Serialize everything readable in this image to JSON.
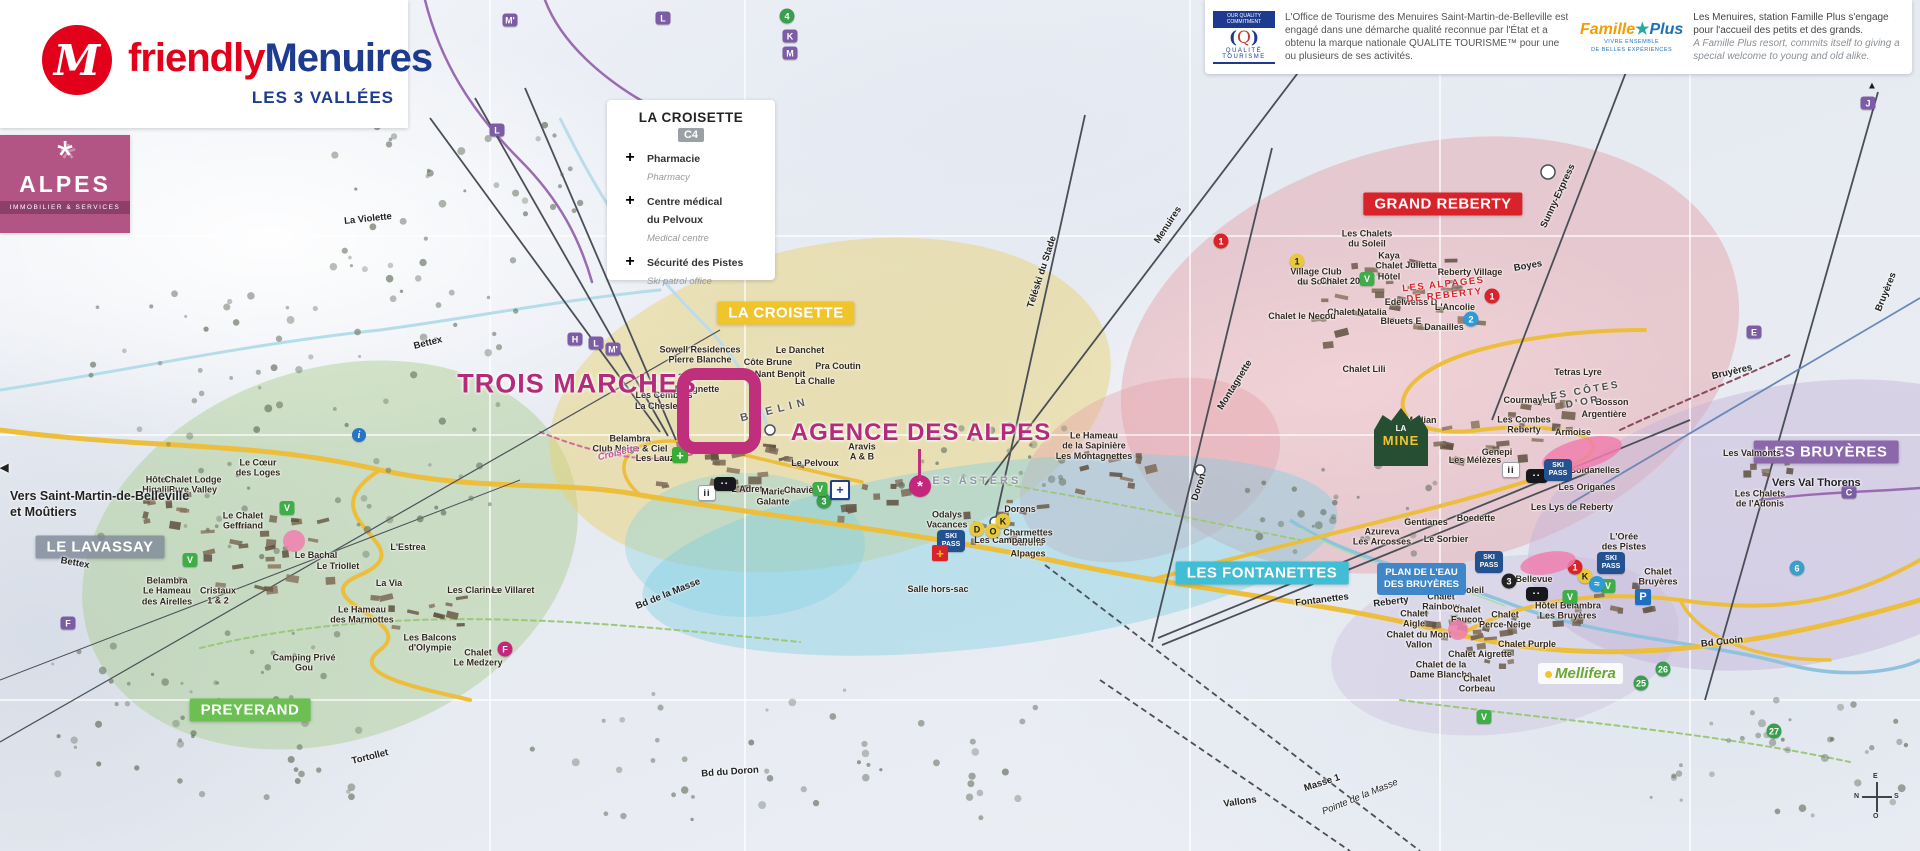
{
  "branding": {
    "logo_icon": "M",
    "logo_friendly": "friendly",
    "logo_menuires": "Menuires",
    "logo_sub": "LES 3 VALLÉES",
    "alpes_icon": "*",
    "alpes_title": "ALPES",
    "alpes_sub": "IMMOBILIER & SERVICES"
  },
  "legend": {
    "title": "LA CROISETTE",
    "grid_ref": "C4",
    "items": [
      {
        "icon": "pharmacy-cross",
        "glyph": "+",
        "fr": "Pharmacie",
        "en": "Pharmacy",
        "cls": "ph"
      },
      {
        "icon": "medical-cross",
        "glyph": "+",
        "fr": "Centre médical\ndu Pelvoux",
        "en": "Medical centre",
        "cls": "med"
      },
      {
        "icon": "ski-patrol-cross",
        "glyph": "+",
        "fr": "Sécurité des Pistes",
        "en": "Ski patrol office",
        "cls": "pat"
      }
    ]
  },
  "quality": {
    "commit": "OUR QUALITY\nCOMMITMENT",
    "art": "Q",
    "name": "QUALITÉ\nTOURISME",
    "text": "L'Office de Tourisme des Menuires Saint-Martin-de-Belleville est engagé dans une démarche qualité reconnue par l'État et a obtenu la marque nationale QUALITE TOURISME™ pour une ou plusieurs de ses activités."
  },
  "famille": {
    "fam": "Famille",
    "star": "★",
    "plus": "Plus",
    "sub": "VIVRE ENSEMBLE\nDE BELLES EXPÉRIENCES",
    "text_fr": "Les Menuires, station Famille Plus s'engage pour l'accueil des petits et des grands.",
    "text_en": "A Famille Plus resort, commits itself to giving a special welcome to young and old alike."
  },
  "highlights": {
    "trois_marches": "TROIS MARCHES",
    "agence": "AGENCE DES ALPES"
  },
  "edges": {
    "vers_left": "Vers Saint-Martin-de-Belleville\net Moûtiers",
    "vers_left_arrow": "◀",
    "vers_right": "Vers Val Thorens",
    "la_mine_top": "LA",
    "la_mine_main": "MINE",
    "plan_eau": "PLAN DE L'EAU\nDES BRUYÈRES",
    "mellifera": "Mellifera",
    "compass": {
      "top": "E",
      "bottom": "O",
      "left": "N",
      "right": "S"
    }
  },
  "districts": [
    {
      "n": "district-la-croisette",
      "t": "LA CROISETTE",
      "x": 786,
      "y": 313,
      "bg": "#f0c52c"
    },
    {
      "n": "district-grand-reberty",
      "t": "GRAND REBERTY",
      "x": 1443,
      "y": 204,
      "bg": "#d8232a"
    },
    {
      "n": "district-les-fontanettes",
      "t": "LES FONTANETTES",
      "x": 1262,
      "y": 573,
      "bg": "#41bdd6"
    },
    {
      "n": "district-les-bruyeres",
      "t": "LES BRUYÈRES",
      "x": 1826,
      "y": 452,
      "bg": "#8a68aa"
    },
    {
      "n": "district-preyerand",
      "t": "PREYERAND",
      "x": 250,
      "y": 710,
      "bg": "#6cbf53"
    },
    {
      "n": "district-le-lavassay",
      "t": "LE LAVASSAY",
      "x": 100,
      "y": 547,
      "bg": "rgba(125,135,150,0.8)"
    }
  ],
  "places": [
    {
      "n": "label-sowell",
      "t": "Sowell Residences\nPierre Blanche",
      "x": 700,
      "y": 355
    },
    {
      "t": "Le Danchet",
      "x": 800,
      "y": 350
    },
    {
      "t": "Côte Brune",
      "x": 768,
      "y": 362
    },
    {
      "t": "Pra Coutin",
      "x": 838,
      "y": 366
    },
    {
      "t": "Nant Benoit",
      "x": 780,
      "y": 374
    },
    {
      "t": "La Challe",
      "x": 815,
      "y": 381
    },
    {
      "t": "3 Marches",
      "x": 700,
      "y": 377
    },
    {
      "t": "Dougnette",
      "x": 697,
      "y": 389
    },
    {
      "t": "Les Cembros",
      "x": 664,
      "y": 395
    },
    {
      "t": "La Chesleia",
      "x": 660,
      "y": 406
    },
    {
      "t": "Belambra\nClub Neige & Ciel",
      "x": 630,
      "y": 444
    },
    {
      "t": "Les Lauzes",
      "x": 660,
      "y": 458
    },
    {
      "t": "Le Pelvoux",
      "x": 815,
      "y": 463
    },
    {
      "t": "Aravis\nA & B",
      "x": 862,
      "y": 452
    },
    {
      "t": "L'Adret",
      "x": 747,
      "y": 489
    },
    {
      "t": "Marie\nGalante",
      "x": 773,
      "y": 497
    },
    {
      "t": "Chavière",
      "x": 803,
      "y": 490
    },
    {
      "t": "Odalys\nVacances",
      "x": 947,
      "y": 520
    },
    {
      "t": "Dorons",
      "x": 1020,
      "y": 509
    },
    {
      "t": "Charmettes\nBurons\nAlpages",
      "x": 1028,
      "y": 543
    },
    {
      "t": "Le Hameau\nde la Sapinière",
      "x": 1094,
      "y": 441
    },
    {
      "t": "Les Montagnettes",
      "x": 1094,
      "y": 456
    },
    {
      "t": "Salle hors-sac",
      "x": 938,
      "y": 589
    },
    {
      "t": "Hôtel\nHigalik",
      "x": 157,
      "y": 485
    },
    {
      "t": "Chalet Lodge\nPure Valley",
      "x": 193,
      "y": 485
    },
    {
      "t": "Le Cœur\ndes Loges",
      "x": 258,
      "y": 468
    },
    {
      "t": "Le Chalet\nGeffriand",
      "x": 243,
      "y": 521
    },
    {
      "t": "Belambra\nLe Hameau\ndes Airelles",
      "x": 167,
      "y": 591
    },
    {
      "t": "Cristaux\n1 & 2",
      "x": 218,
      "y": 596
    },
    {
      "t": "Le Bachal",
      "x": 316,
      "y": 555
    },
    {
      "t": "Le Triollet",
      "x": 338,
      "y": 566
    },
    {
      "t": "La Via",
      "x": 389,
      "y": 583
    },
    {
      "t": "L'Estrea",
      "x": 408,
      "y": 547
    },
    {
      "t": "Les Clarines",
      "x": 474,
      "y": 590
    },
    {
      "t": "Le Villaret",
      "x": 513,
      "y": 590
    },
    {
      "t": "Le Hameau\ndes Marmottes",
      "x": 362,
      "y": 615
    },
    {
      "t": "Les Balcons\nd'Olympie",
      "x": 430,
      "y": 643
    },
    {
      "t": "Chalet\nLe Medzery",
      "x": 478,
      "y": 658
    },
    {
      "t": "Camping Privé\nGou",
      "x": 304,
      "y": 663
    },
    {
      "t": "Les Chalets\ndu Soleil",
      "x": 1367,
      "y": 239
    },
    {
      "t": "Village Club\ndu Soleil",
      "x": 1316,
      "y": 277
    },
    {
      "t": "Kaya\nChalet\nHôtel",
      "x": 1389,
      "y": 266
    },
    {
      "t": "Julietta",
      "x": 1421,
      "y": 265
    },
    {
      "t": "Chalet 2000",
      "x": 1345,
      "y": 281
    },
    {
      "t": "Reberty Village",
      "x": 1470,
      "y": 272
    },
    {
      "t": "Edelweiss D",
      "x": 1411,
      "y": 302
    },
    {
      "t": "L'Ancolie",
      "x": 1455,
      "y": 307
    },
    {
      "t": "Bleuets E",
      "x": 1401,
      "y": 321
    },
    {
      "t": "Danailles",
      "x": 1444,
      "y": 327
    },
    {
      "t": "Chalet Natalia",
      "x": 1357,
      "y": 312
    },
    {
      "t": "Chalet le Necou",
      "x": 1302,
      "y": 316
    },
    {
      "t": "Chalet Lili",
      "x": 1364,
      "y": 369
    },
    {
      "t": "Tetras Lyre",
      "x": 1578,
      "y": 372
    },
    {
      "t": "Courmayeur",
      "x": 1530,
      "y": 400
    },
    {
      "t": "Bosson",
      "x": 1612,
      "y": 402
    },
    {
      "t": "Argentière",
      "x": 1604,
      "y": 414
    },
    {
      "t": "Les Combes\nReberty",
      "x": 1524,
      "y": 425
    },
    {
      "t": "Armoise",
      "x": 1573,
      "y": 432
    },
    {
      "t": "Median",
      "x": 1421,
      "y": 420
    },
    {
      "t": "Genepi",
      "x": 1497,
      "y": 452
    },
    {
      "t": "Les Mélèzes",
      "x": 1475,
      "y": 460
    },
    {
      "t": "Les Soldanelles",
      "x": 1586,
      "y": 470
    },
    {
      "t": "Les Origanes",
      "x": 1587,
      "y": 487
    },
    {
      "t": "Les Lys de Reberty",
      "x": 1572,
      "y": 507
    },
    {
      "t": "Gentianes",
      "x": 1426,
      "y": 522
    },
    {
      "t": "Azureva\nLes Arcosses",
      "x": 1382,
      "y": 537
    },
    {
      "t": "Le Sorbier",
      "x": 1446,
      "y": 539
    },
    {
      "t": "Boedette",
      "x": 1476,
      "y": 518
    },
    {
      "t": "La Biellaz",
      "x": 1411,
      "y": 575
    },
    {
      "t": "Ski Soleil",
      "x": 1464,
      "y": 590
    },
    {
      "t": "Chalet\nRainbow",
      "x": 1441,
      "y": 602
    },
    {
      "t": "Chalet\nAigle",
      "x": 1414,
      "y": 619
    },
    {
      "t": "Chalet\nFaucon",
      "x": 1467,
      "y": 615
    },
    {
      "t": "Chalet du Mont\nVallon",
      "x": 1419,
      "y": 640
    },
    {
      "t": "Chalet\nPerce-Neige",
      "x": 1505,
      "y": 620
    },
    {
      "t": "Chalet Purple",
      "x": 1527,
      "y": 644
    },
    {
      "t": "Chalet Aigrette",
      "x": 1480,
      "y": 654
    },
    {
      "t": "Chalet de la\nDame Blanche",
      "x": 1441,
      "y": 670
    },
    {
      "t": "Chalet\nCorbeau",
      "x": 1477,
      "y": 684
    },
    {
      "t": "Hôtel Belambra\nLes Bruyères",
      "x": 1568,
      "y": 611
    },
    {
      "t": "L'Orée\ndes Pistes",
      "x": 1624,
      "y": 542
    },
    {
      "t": "Bellevue",
      "x": 1534,
      "y": 579
    },
    {
      "t": "Chalet\nBruyères",
      "x": 1658,
      "y": 577
    },
    {
      "t": "Les Campanules",
      "x": 1010,
      "y": 540
    },
    {
      "t": "Les Chalets\nde l'Adonis",
      "x": 1760,
      "y": 499
    },
    {
      "t": "Les Valmonts",
      "x": 1752,
      "y": 453
    }
  ],
  "routes": [
    {
      "n": "road-bettex",
      "t": "Bettex",
      "x": 428,
      "y": 343,
      "r": -14
    },
    {
      "t": "Bettex",
      "x": 75,
      "y": 563,
      "r": 10
    },
    {
      "t": "La Violette",
      "x": 368,
      "y": 219,
      "r": -6
    },
    {
      "n": "lift-menuires",
      "t": "Menuires",
      "x": 1168,
      "y": 225,
      "r": -57
    },
    {
      "n": "lift-teleski-du-stade",
      "t": "Téléski du Stade",
      "x": 1042,
      "y": 272,
      "r": -72
    },
    {
      "n": "lift-sunny-express",
      "t": "Sunny-Express",
      "x": 1558,
      "y": 196,
      "r": -65
    },
    {
      "n": "lift-bruyeres",
      "t": "Bruyères",
      "x": 1732,
      "y": 372,
      "r": -13
    },
    {
      "t": "Bruyères",
      "x": 1886,
      "y": 292,
      "r": -68
    },
    {
      "n": "lift-doron",
      "t": "Doron",
      "x": 1199,
      "y": 487,
      "r": -72
    },
    {
      "n": "lift-fontanettes",
      "t": "Fontanettes",
      "x": 1322,
      "y": 600,
      "r": -7
    },
    {
      "n": "lift-reberty",
      "t": "Reberty",
      "x": 1391,
      "y": 602,
      "r": -7
    },
    {
      "t": "Montagnette",
      "x": 1235,
      "y": 385,
      "r": -58
    },
    {
      "t": "Boyes",
      "x": 1528,
      "y": 266,
      "r": -10
    },
    {
      "t": "Bd de la Masse",
      "x": 668,
      "y": 594,
      "r": -22
    },
    {
      "t": "Bd du Doron",
      "x": 730,
      "y": 772,
      "r": -4
    },
    {
      "t": "Bd Cuoin",
      "x": 1722,
      "y": 642,
      "r": -6
    },
    {
      "t": "Tortollet",
      "x": 370,
      "y": 757,
      "r": -14
    },
    {
      "t": "Vallons",
      "x": 1240,
      "y": 802,
      "r": -8
    },
    {
      "t": "Masse 1",
      "x": 1322,
      "y": 783,
      "r": -18
    },
    {
      "t": "Pointe de la Masse",
      "x": 1360,
      "y": 797,
      "r": -22,
      "cls": "ital"
    },
    {
      "n": "area-brelin",
      "t": "BRELIN",
      "x": 775,
      "y": 410,
      "r": -14,
      "cls": "brelin"
    },
    {
      "t": "Croisette",
      "x": 618,
      "y": 453,
      "r": -14,
      "cls": "mag"
    },
    {
      "n": "area-les-cotes-d-or",
      "t": "LES CÔTES\nD'OR",
      "x": 1582,
      "y": 397,
      "r": -10,
      "cls": "spaced"
    },
    {
      "n": "area-les-alpages-de-reberty",
      "t": "LES ALPAGES\nDE REBERTY",
      "x": 1444,
      "y": 290,
      "r": -6,
      "cls": "red"
    },
    {
      "n": "area-les-asters",
      "t": "LES ASTERS",
      "x": 972,
      "y": 481,
      "r": 0,
      "cls": "gray"
    }
  ],
  "lift_badges": [
    {
      "n": "lift-badge-m2",
      "t": "M'",
      "x": 510,
      "y": 20,
      "bg": "#7b5ca5"
    },
    {
      "n": "lift-badge-l",
      "t": "L",
      "x": 663,
      "y": 18,
      "bg": "#7b5ca5"
    },
    {
      "t": "L",
      "x": 497,
      "y": 130,
      "bg": "#7b5ca5"
    },
    {
      "t": "K",
      "x": 790,
      "y": 36,
      "bg": "#7b5ca5"
    },
    {
      "t": "M",
      "x": 790,
      "y": 53,
      "bg": "#7b5ca5"
    },
    {
      "t": "H",
      "x": 575,
      "y": 339,
      "bg": "#7b5ca5"
    },
    {
      "t": "L",
      "x": 596,
      "y": 343,
      "bg": "#7b5ca5"
    },
    {
      "t": "M'",
      "x": 613,
      "y": 349,
      "bg": "#7b5ca5"
    },
    {
      "t": "J",
      "x": 1868,
      "y": 103,
      "bg": "#7b5ca5"
    },
    {
      "t": "E",
      "x": 1754,
      "y": 332,
      "bg": "#7b5ca5"
    },
    {
      "t": "C",
      "x": 1849,
      "y": 492,
      "bg": "#7b5ca5"
    },
    {
      "t": "F",
      "x": 68,
      "y": 623,
      "bg": "#7b5ca5"
    },
    {
      "t": "F",
      "x": 505,
      "y": 649,
      "bg": "#c4267e",
      "cls": "circ"
    },
    {
      "t": "D",
      "x": 977,
      "y": 529,
      "bg": "#e8c93e",
      "cls": "circ dark"
    },
    {
      "t": "O",
      "x": 993,
      "y": 531,
      "bg": "#e8c93e",
      "cls": "circ dark"
    },
    {
      "t": "K",
      "x": 1003,
      "y": 521,
      "bg": "#e8c93e",
      "cls": "circ dark"
    },
    {
      "t": "K",
      "x": 1585,
      "y": 576,
      "bg": "#e8c93e",
      "cls": "circ dark"
    }
  ],
  "numbers": [
    {
      "n": "piste-marker-4",
      "t": "4",
      "x": 787,
      "y": 16,
      "bg": "#3a9e4e"
    },
    {
      "t": "1",
      "x": 1492,
      "y": 296,
      "bg": "#d8232a"
    },
    {
      "t": "2",
      "x": 1471,
      "y": 319,
      "bg": "#2e9bd6"
    },
    {
      "t": "1",
      "x": 1221,
      "y": 241,
      "bg": "#d8232a"
    },
    {
      "t": "1",
      "x": 1297,
      "y": 261,
      "bg": "#e8c93e",
      "cls": "dark"
    },
    {
      "t": "1",
      "x": 1575,
      "y": 567,
      "bg": "#d8232a"
    },
    {
      "t": "3",
      "x": 1509,
      "y": 581,
      "bg": "#222222"
    },
    {
      "t": "3",
      "x": 824,
      "y": 501,
      "bg": "#3a9e4e"
    },
    {
      "t": "6",
      "x": 1797,
      "y": 568,
      "bg": "#3aa0c8"
    },
    {
      "t": "25",
      "x": 1641,
      "y": 683,
      "bg": "#3a9e4e"
    },
    {
      "t": "26",
      "x": 1663,
      "y": 669,
      "bg": "#3a9e4e"
    },
    {
      "t": "27",
      "x": 1774,
      "y": 731,
      "bg": "#3a9e4e"
    }
  ],
  "pois": [
    {
      "n": "poi-v-badge",
      "t": "V",
      "x": 287,
      "y": 508,
      "cls": "vbdg"
    },
    {
      "t": "V",
      "x": 190,
      "y": 560,
      "cls": "vbdg"
    },
    {
      "t": "V",
      "x": 820,
      "y": 489,
      "cls": "vbdg"
    },
    {
      "t": "V",
      "x": 1367,
      "y": 279,
      "cls": "vbdg"
    },
    {
      "t": "V",
      "x": 1570,
      "y": 597,
      "cls": "vbdg"
    },
    {
      "t": "V",
      "x": 1608,
      "y": 586,
      "cls": "vbdg"
    },
    {
      "t": "V",
      "x": 1484,
      "y": 717,
      "cls": "vbdg"
    },
    {
      "n": "poi-info",
      "t": "i",
      "x": 359,
      "y": 435,
      "cls": "info"
    },
    {
      "n": "poi-parking",
      "t": "P",
      "x": 1643,
      "y": 597,
      "cls": "pbdg"
    },
    {
      "n": "poi-pool",
      "t": "≈",
      "x": 1597,
      "y": 584,
      "cls": "swim"
    },
    {
      "n": "poi-people",
      "t": "ii",
      "x": 1511,
      "y": 470,
      "cls": "ppl"
    },
    {
      "t": "ii",
      "x": 707,
      "y": 493,
      "cls": "ppl"
    },
    {
      "n": "poi-gondola",
      "t": "▪▪",
      "x": 725,
      "y": 484,
      "cls": "gond"
    },
    {
      "t": "▪▪",
      "x": 1537,
      "y": 476,
      "cls": "gond"
    },
    {
      "t": "▪▪",
      "x": 1537,
      "y": 594,
      "cls": "gond"
    },
    {
      "n": "poi-ski-pass",
      "t": "SKI\nPASS",
      "x": 951,
      "y": 541,
      "cls": "skipass"
    },
    {
      "t": "SKI\nPASS",
      "x": 1489,
      "y": 562,
      "cls": "skipass"
    },
    {
      "t": "SKI\nPASS",
      "x": 1611,
      "y": 563,
      "cls": "skipass"
    },
    {
      "t": "SKI\nPASS",
      "x": 1558,
      "y": 470,
      "cls": "skipass"
    },
    {
      "n": "poi-pharmacy",
      "t": "+",
      "x": 680,
      "y": 455,
      "cls": "xgreen"
    },
    {
      "n": "poi-medical-centre",
      "t": "+",
      "x": 840,
      "y": 490,
      "cls": "xmed"
    },
    {
      "n": "poi-ski-patrol",
      "t": "+",
      "x": 940,
      "y": 553,
      "cls": "xpatrol"
    },
    {
      "n": "poi-agency-marker",
      "t": "*",
      "x": 920,
      "y": 486,
      "cls": "agency"
    },
    {
      "n": "poi-sled-area",
      "t": "",
      "x": 1582,
      "y": 454,
      "w": 82,
      "h": 30,
      "r": -15,
      "cls": "oval"
    },
    {
      "t": "",
      "x": 1548,
      "y": 563,
      "w": 56,
      "h": 22,
      "r": -10,
      "cls": "oval"
    },
    {
      "t": "",
      "x": 294,
      "y": 541,
      "w": 22,
      "h": 22,
      "cls": "oval"
    },
    {
      "t": "",
      "x": 1458,
      "y": 630,
      "w": 20,
      "h": 20,
      "cls": "oval"
    },
    {
      "n": "edge-arrow-top-right",
      "t": "▲",
      "x": 1872,
      "y": 86,
      "cls": "arrow"
    }
  ]
}
